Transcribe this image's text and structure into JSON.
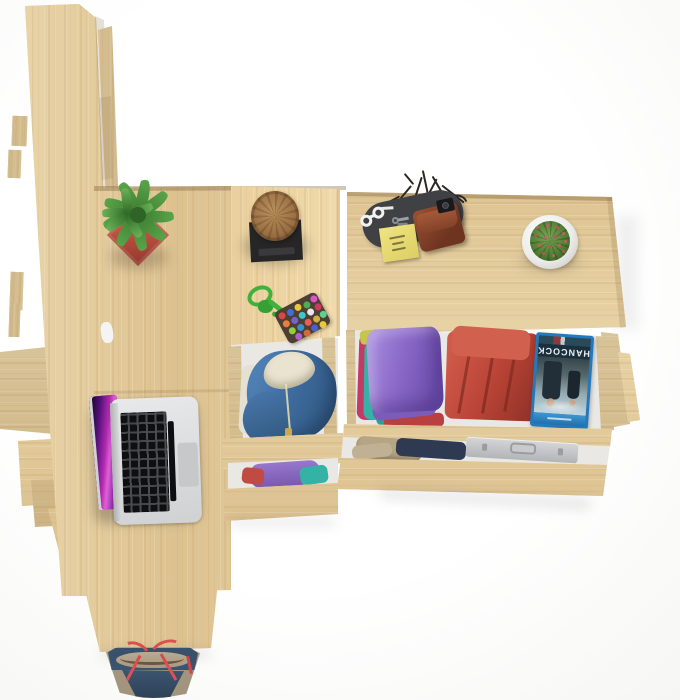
{
  "scene": {
    "description": "Overhead 3D product render of a light-oak desk, tall shelf panels and a chest of open drawers filled with clothes, styled with a laptop, plants and accessories on a white background",
    "background": "#ffffff"
  },
  "palette": {
    "wood": "#e4cfa2",
    "wood_edge": "#6e5028",
    "drawer_interior": "#e9e8e4",
    "pot_red": "#b34a3c",
    "plant_green": "#4a8f3f",
    "stool_wood": "#9a6f42",
    "stool_base": "#262626",
    "rope_green": "#3fb13c",
    "hoodie_blue": "#3f6da2",
    "shirt_purple": "#8a68c8",
    "shirt_teal": "#35b2a6",
    "shirt_magenta": "#c23a66",
    "shirt_red": "#bb4538",
    "khaki": "#b5a584",
    "navy": "#2e3a52",
    "briefcase_silver": "#c9cccd",
    "tray_gray": "#3f4145",
    "wallet_brown": "#6e3420",
    "note_yellow": "#ecdf78",
    "bag_navy": "#3c5570",
    "bag_tan": "#a99b85",
    "strap_red": "#e05050",
    "laptop_silver": "#d9dadb",
    "screen_magenta": "#b32bb0",
    "bluray_blue": "#2478bc"
  },
  "objects": {
    "bluray": {
      "title": "HANCOCK",
      "note": "movie case lying upside-down in drawer"
    },
    "items": [
      "tall oak shelf panels",
      "oak desk surface",
      "open silver laptop with magenta wallpaper",
      "succulent in red square pot",
      "log stool on black base",
      "green rope keychain with multicolour bead pouch",
      "oak chest with two open drawers",
      "valet tray with sunglasses, sticky note, keys, wallet, camera and dry twigs",
      "barrel cactus in white pot",
      "open drawer with blue hoodie and white shirt",
      "drawer with folded purple, teal, magenta and red shirts",
      "drawer with khaki clothes and aluminium briefcase",
      "canvas tote bag with red straps"
    ]
  }
}
